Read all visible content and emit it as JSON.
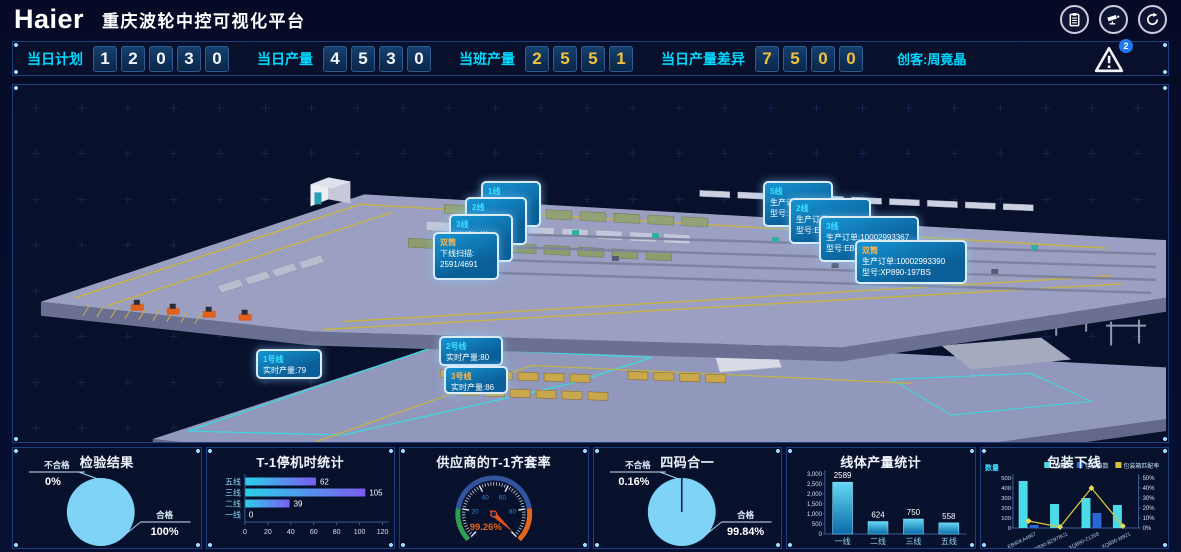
{
  "header": {
    "logo": "Haier",
    "title": "重庆波轮中控可视化平台"
  },
  "kpi_bar": {
    "items": [
      {
        "label": "当日计划",
        "digits": [
          "1",
          "2",
          "0",
          "3",
          "0"
        ]
      },
      {
        "label": "当日产量",
        "digits": [
          "4",
          "5",
          "3",
          "0"
        ]
      },
      {
        "label": "当班产量",
        "digits": [
          "2",
          "5",
          "5",
          "1"
        ]
      },
      {
        "label": "当日产量差异",
        "digits": [
          "7",
          "5",
          "0",
          "0"
        ]
      }
    ],
    "creator": "创客:周竟晶",
    "alert_count": "2"
  },
  "factory": {
    "left_cluster": [
      {
        "title": "1线",
        "line1": "",
        "line2": ""
      },
      {
        "title": "2线",
        "line1": "下线扫描:",
        "line2": ""
      },
      {
        "title": "3线",
        "line1": "下线扫描:",
        "line2": ""
      },
      {
        "title": "双筒",
        "line1": "下线扫描:",
        "line2": "2591/4691"
      }
    ],
    "right_cluster": [
      {
        "title": "5线",
        "line1": "生产订单:",
        "line2": "型号:"
      },
      {
        "title": "2线",
        "line1": "生产订单:1",
        "line2": "型号:E8"
      },
      {
        "title": "3线",
        "line1": "生产订单:10002993367",
        "line2": "型号:EB8"
      },
      {
        "title": "双筒",
        "line1": "生产订单:10002993390",
        "line2": "型号:XP890-197BS"
      }
    ],
    "line_cards": [
      {
        "title": "1号线",
        "line1": "实时产量:79"
      },
      {
        "title": "2号线",
        "line1": "实时产量:80"
      },
      {
        "title": "3号线",
        "line1": "实时产量:86"
      }
    ]
  },
  "chart_data": [
    {
      "type": "pie",
      "title": "检验结果",
      "slices": [
        {
          "label": "不合格",
          "pct": "0%",
          "value": 0
        },
        {
          "label": "合格",
          "pct": "100%",
          "value": 100,
          "color": "#7ed3f7"
        }
      ]
    },
    {
      "type": "bar",
      "orientation": "horizontal",
      "title": "T-1停机时统计",
      "categories": [
        "五线",
        "三线",
        "二线",
        "一线"
      ],
      "values": [
        62,
        105,
        39,
        0
      ],
      "xlim": [
        0,
        120
      ],
      "xticks": [
        0,
        20,
        40,
        60,
        80,
        100,
        120
      ],
      "bar_gradient": [
        "#2ad1e8",
        "#7b5cf0"
      ]
    },
    {
      "type": "gauge",
      "title": "供应商的T-1齐套率",
      "value": 99.26,
      "max": 100,
      "label": "99.26%",
      "segments": [
        {
          "to": 20,
          "color": "#2f9e4f"
        },
        {
          "to": 80,
          "color": "#32549e"
        },
        {
          "to": 100,
          "color": "#e2661c"
        }
      ],
      "tick_labels": [
        20,
        40,
        60,
        80
      ]
    },
    {
      "type": "pie",
      "title": "四码合一",
      "slices": [
        {
          "label": "不合格",
          "pct": "0.16%",
          "value": 0.16
        },
        {
          "label": "合格",
          "pct": "99.84%",
          "value": 99.84,
          "color": "#7ed3f7"
        }
      ]
    },
    {
      "type": "bar",
      "orientation": "vertical",
      "title": "线体产量统计",
      "categories": [
        "一线",
        "二线",
        "三线",
        "五线"
      ],
      "values": [
        2589,
        624,
        750,
        558
      ],
      "ylim": [
        0,
        3000
      ],
      "yticks": [
        0,
        500,
        1000,
        1500,
        2000,
        2500,
        3000
      ],
      "bar_gradient": [
        "#66d8f4",
        "#0a6aa8"
      ]
    },
    {
      "type": "combo",
      "title": "包装下线",
      "ylabel_left": "数量",
      "categories": [
        "EB80KA4867",
        "XQB90-BZ978U1",
        "XQB80-Z1268",
        "XQB90-M921"
      ],
      "ylim_left": [
        0,
        500
      ],
      "yticks_left": [
        0,
        100,
        200,
        300,
        400,
        500
      ],
      "ylim_right": [
        0,
        50
      ],
      "yticks_right": [
        "0%",
        "10%",
        "20%",
        "30%",
        "40%",
        "50%"
      ],
      "series": [
        {
          "name": "订单数",
          "kind": "bar",
          "color": "#49dce8",
          "values": [
            470,
            240,
            300,
            230
          ]
        },
        {
          "name": "包装箱数",
          "kind": "bar",
          "color": "#2a66d4",
          "values": [
            30,
            5,
            150,
            5
          ]
        },
        {
          "name": "包装箱匹配率",
          "kind": "line",
          "color": "#d8c23a",
          "values": [
            7,
            1,
            40,
            2
          ],
          "axis": "right"
        }
      ]
    }
  ]
}
